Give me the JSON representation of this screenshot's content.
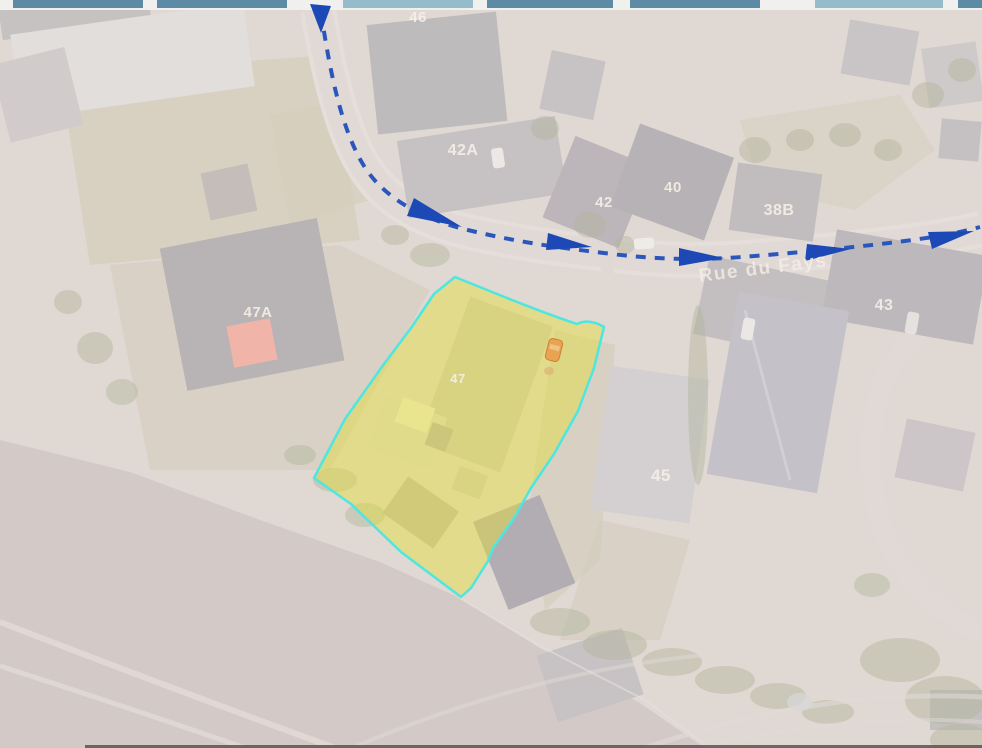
{
  "toolbar": {
    "background_color": "#f0f0ef",
    "buttons": [
      {
        "color": "#5d8ba6"
      },
      {
        "color": "#5d8ba6"
      },
      {
        "color": "#96bccb"
      },
      {
        "color": "#5d8ba6"
      },
      {
        "color": "#5d8ba6"
      },
      {
        "color": "#96bccb"
      },
      {
        "color": "#5d8ba6"
      }
    ]
  },
  "map": {
    "street_label": {
      "text": "Rue du Fays",
      "color": "#f6f0e8"
    },
    "house_numbers": [
      {
        "text": "46"
      },
      {
        "text": "42A"
      },
      {
        "text": "42"
      },
      {
        "text": "40"
      },
      {
        "text": "38B"
      },
      {
        "text": "47A"
      },
      {
        "text": "47"
      },
      {
        "text": "43"
      },
      {
        "text": "45"
      }
    ],
    "parcel_highlight": {
      "label": "47",
      "fill_color": "#e4e03c",
      "border_color": "#4de6e0"
    },
    "route_overlay": {
      "line_color": "#2150bb",
      "arrow_color": "#1c49b5",
      "style": "dashed"
    },
    "vehicle_highlight": {
      "color": "#e9a452"
    },
    "roof_highlight_47A": {
      "color": "#efa091"
    }
  }
}
